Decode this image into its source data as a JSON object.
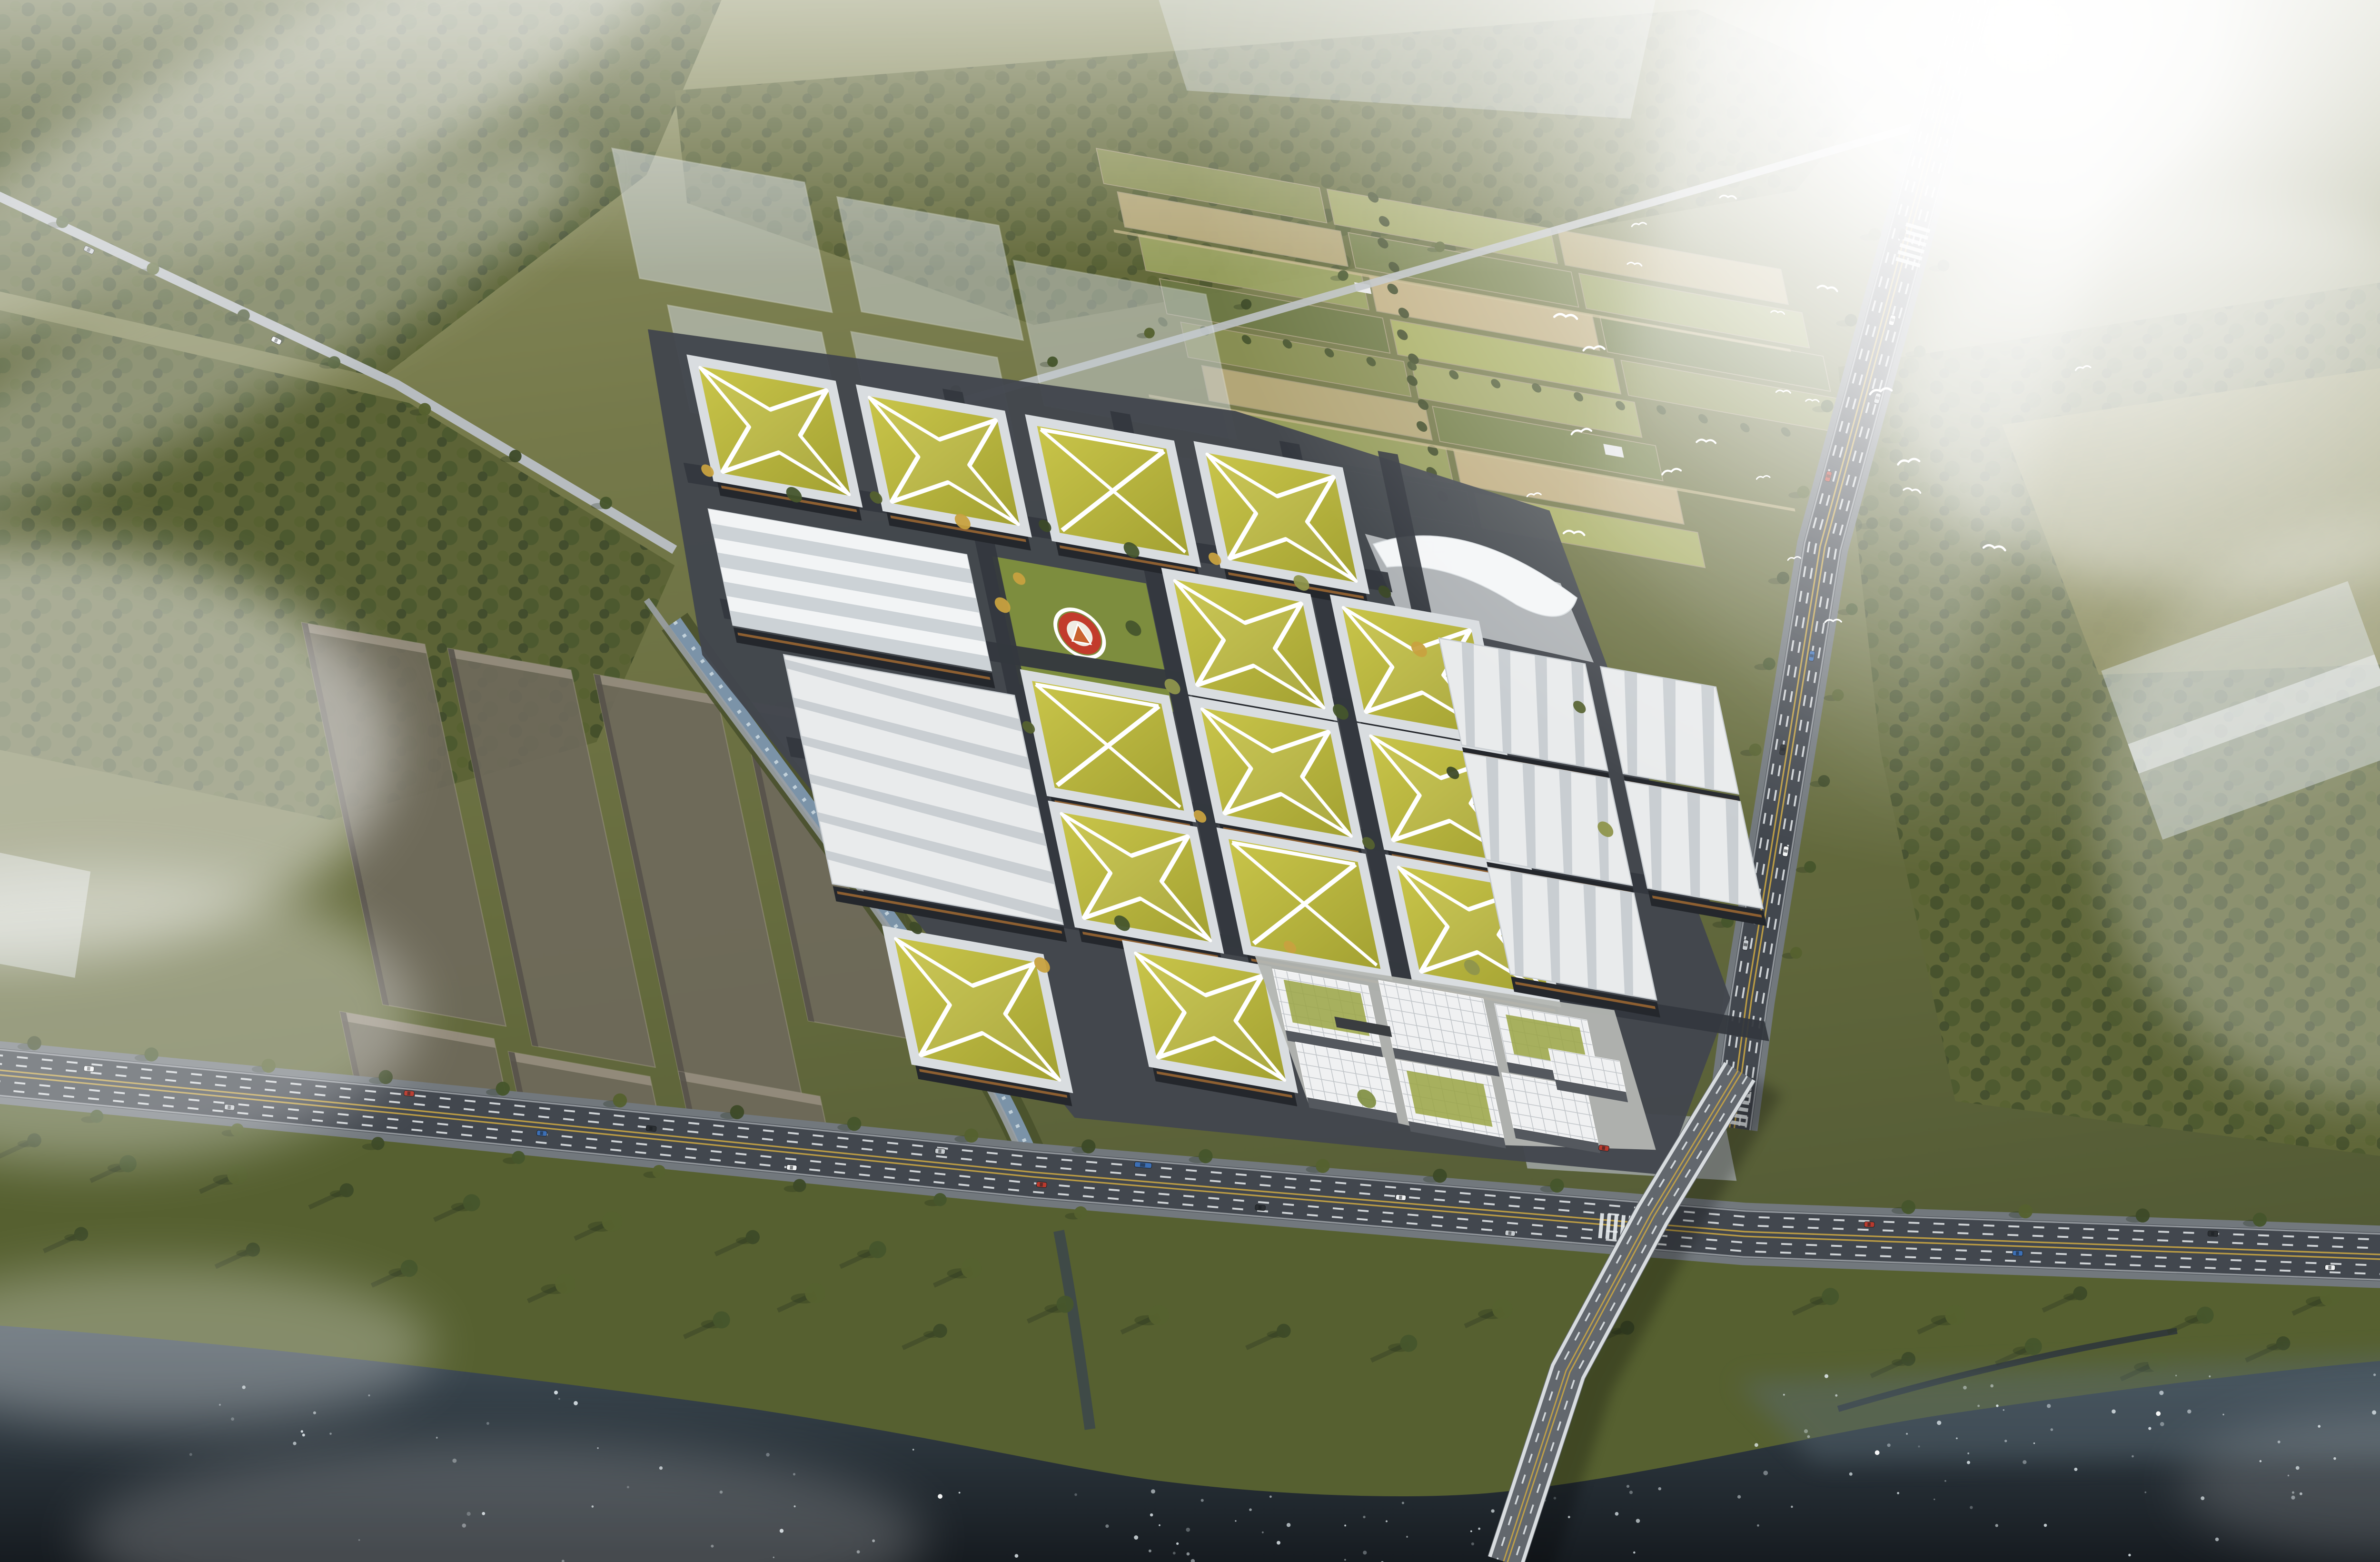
{
  "scene": {
    "type": "aerial-architectural-rendering",
    "subject": "Bird's-eye CGI masterplan visualization of a riverside industrial campus with green star-patterned roofs, white factory halls, farmland, a highway and a bridge over a dark river, in hazy morning light",
    "lighting": "strong hazy sun glare from the upper right, long shadows cast to the lower left",
    "no_visible_text": true
  },
  "palette": {
    "ground": "#75794a",
    "ground_light": "#8e9163",
    "ground_dark": "#4f5733",
    "forest": "#3d4a28",
    "farm_colors": [
      "#8a9054",
      "#a3a866",
      "#b7a97a",
      "#75804a",
      "#98a05e",
      "#c4b184",
      "#6d7845",
      "#aab063"
    ],
    "tree_colors": [
      "#3d4a28",
      "#46552c",
      "#55612f",
      "#8f954c"
    ],
    "autumn_tree": "#c8a13f",
    "roof_grass_light": "#c9c54a",
    "roof_grass_dark": "#a3a132",
    "roof_path": "#ffffff",
    "facade_dark": "#24272c",
    "facade_copper": "#a06a32",
    "factory_white": "#e9ebec",
    "factory_stripe": "#c3c9ce",
    "parapet": "#d9dde0",
    "asphalt": "#42474e",
    "road_verge": "#72787d",
    "road_light": "#b7bcc0",
    "lane_white": "#e8ecef",
    "lane_yellow": "#c9a544",
    "water_surface": "#46535c",
    "water_mid": "#323d45",
    "water_deep": "#161b20",
    "sparkle": "#e8f1f5",
    "canal_water": "#7b93a8",
    "helipad_red": "#c23b2c",
    "helipad_white": "#efece4",
    "helipad_logo": "#c9622f",
    "ghost_block": "#ccd3d8",
    "massing_plot": "#6f6a5c",
    "massing_top": "#968e7e",
    "plaza": "#b4b6b2",
    "lawn": "#7d8d3e",
    "car_colors": [
      "#f2f4f5",
      "#c7ccd0",
      "#b83a2e",
      "#3c6fb5",
      "#2b2f33"
    ],
    "mist": "#ffffff"
  },
  "inventory": {
    "green_star_roof_buildings": 14,
    "white_factory_halls": 6,
    "gabled_warehouse": 1,
    "modular_housing_blocks": 7,
    "helipad": 1,
    "entrance_canopy": 1,
    "bridge": 1,
    "bird_flock_count": 22,
    "vehicles_visible": 29,
    "ghost_massing_blocks": 9,
    "dark_reserve_plots": 7,
    "farmland_plots": 20
  }
}
